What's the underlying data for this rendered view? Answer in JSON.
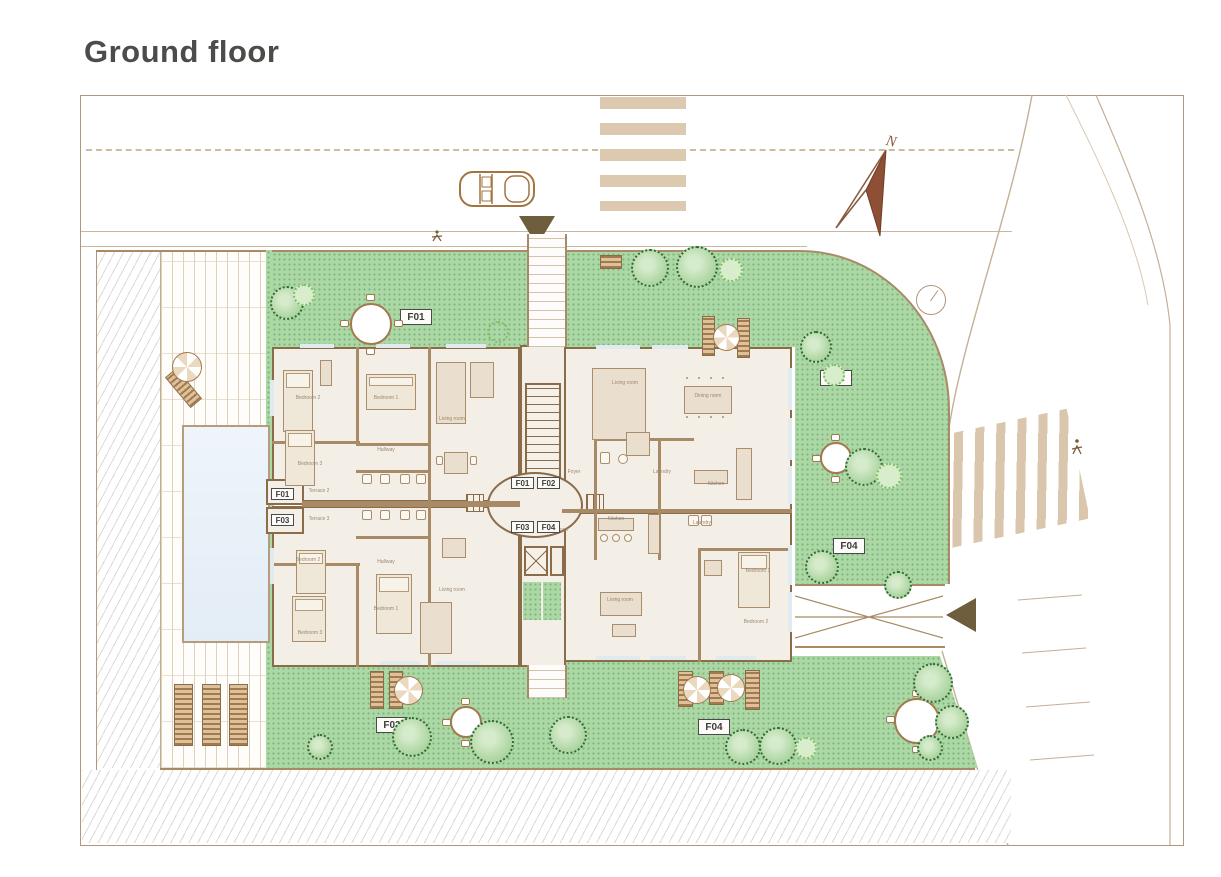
{
  "page": {
    "title": "Ground floor"
  },
  "compass": {
    "north_label": "N"
  },
  "apartments": {
    "f01": "F01",
    "f02": "F02",
    "f03": "F03",
    "f04": "F04"
  },
  "rooms": {
    "living": "Living room",
    "dining": "Dining room",
    "kitchen": "Kitchen",
    "bedroom1": "Bedroom 1",
    "bedroom2": "Bedroom 2",
    "bedroom3": "Bedroom 3",
    "hallway": "Hallway",
    "foyer": "Foyer",
    "laundry": "Laundry",
    "terrace2": "Terrace 2",
    "terrace3": "Terrace 3"
  },
  "colors": {
    "lawn": "#abd8a4",
    "wall": "#a98a66",
    "room_fill": "#f4efe6",
    "pool": "#e9f2f9",
    "stripe_tan": "#dcc9b0",
    "arrow_dark": "#6e5e3d",
    "compass_red": "#8f4f35",
    "title_text": "#4c4c4a",
    "tree_dark": "#2e6b34",
    "tree_light": "#7fbf66"
  }
}
